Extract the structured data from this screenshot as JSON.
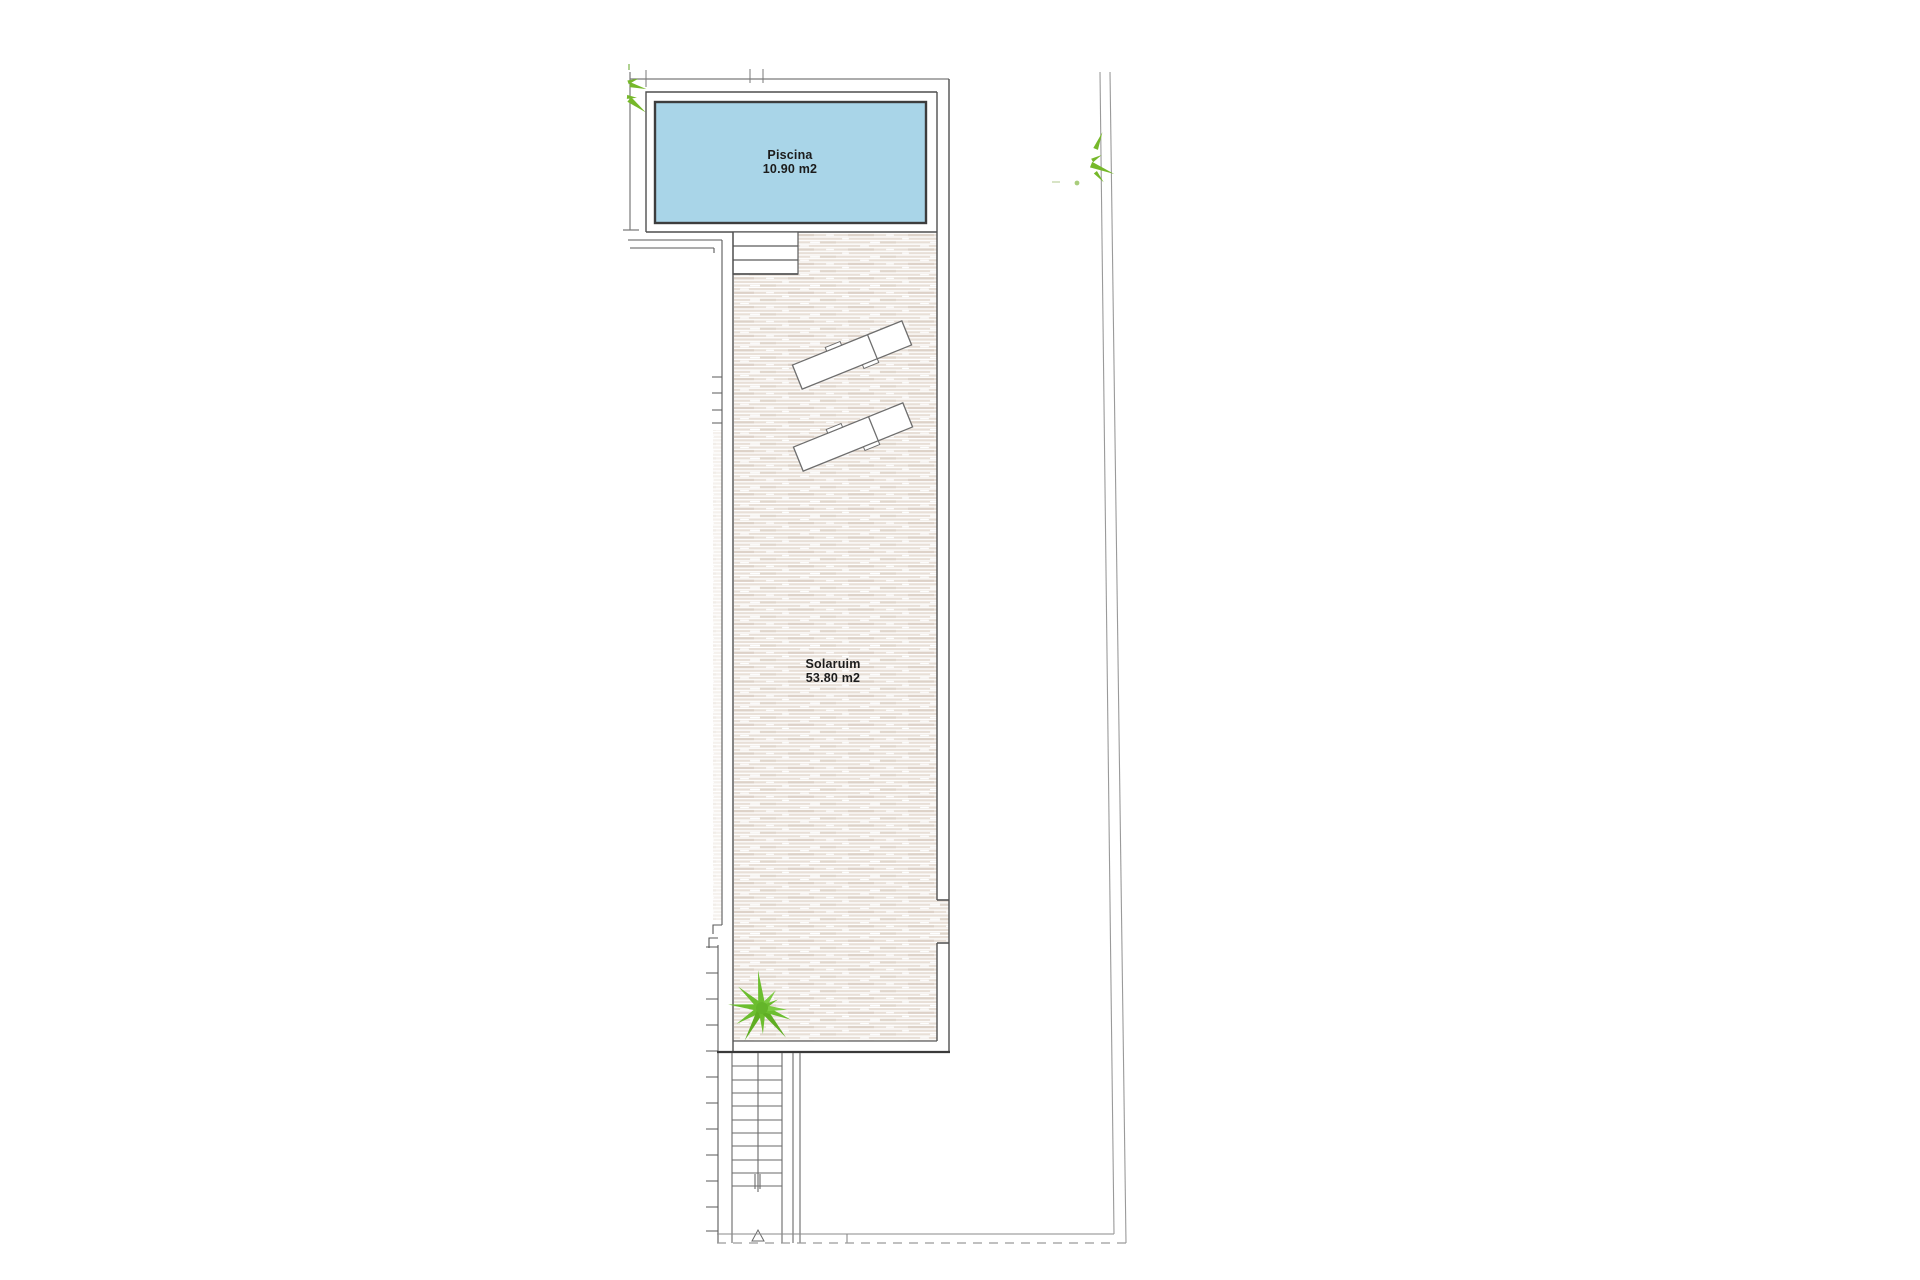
{
  "plan": {
    "rooms": {
      "piscina": {
        "name": "Piscina",
        "area": "10.90 m2"
      },
      "solarium": {
        "name": "Solaruim",
        "area": "53.80 m2"
      }
    },
    "icons": [
      "palm-tree-icon",
      "shrub-icon",
      "sun-lounger-icon",
      "stairs-icon",
      "pool-steps-icon"
    ],
    "counts": {
      "sun_loungers": 2,
      "stair_treads": 10,
      "pool_steps": 3
    },
    "colors": {
      "background": "#ffffff",
      "pool_fill": "#a9d5e8",
      "pool_border": "#3d3d3d",
      "deck_stripe": "#e8dfd7",
      "deck_stripe_dark": "#ddd2c8",
      "wall_line": "#5a5a5a",
      "heavy_line": "#3a3a3a",
      "boundary_line": "#9a9a9a",
      "plant_green": "#6cbe2f",
      "label_text": "#1c1c1c"
    }
  }
}
